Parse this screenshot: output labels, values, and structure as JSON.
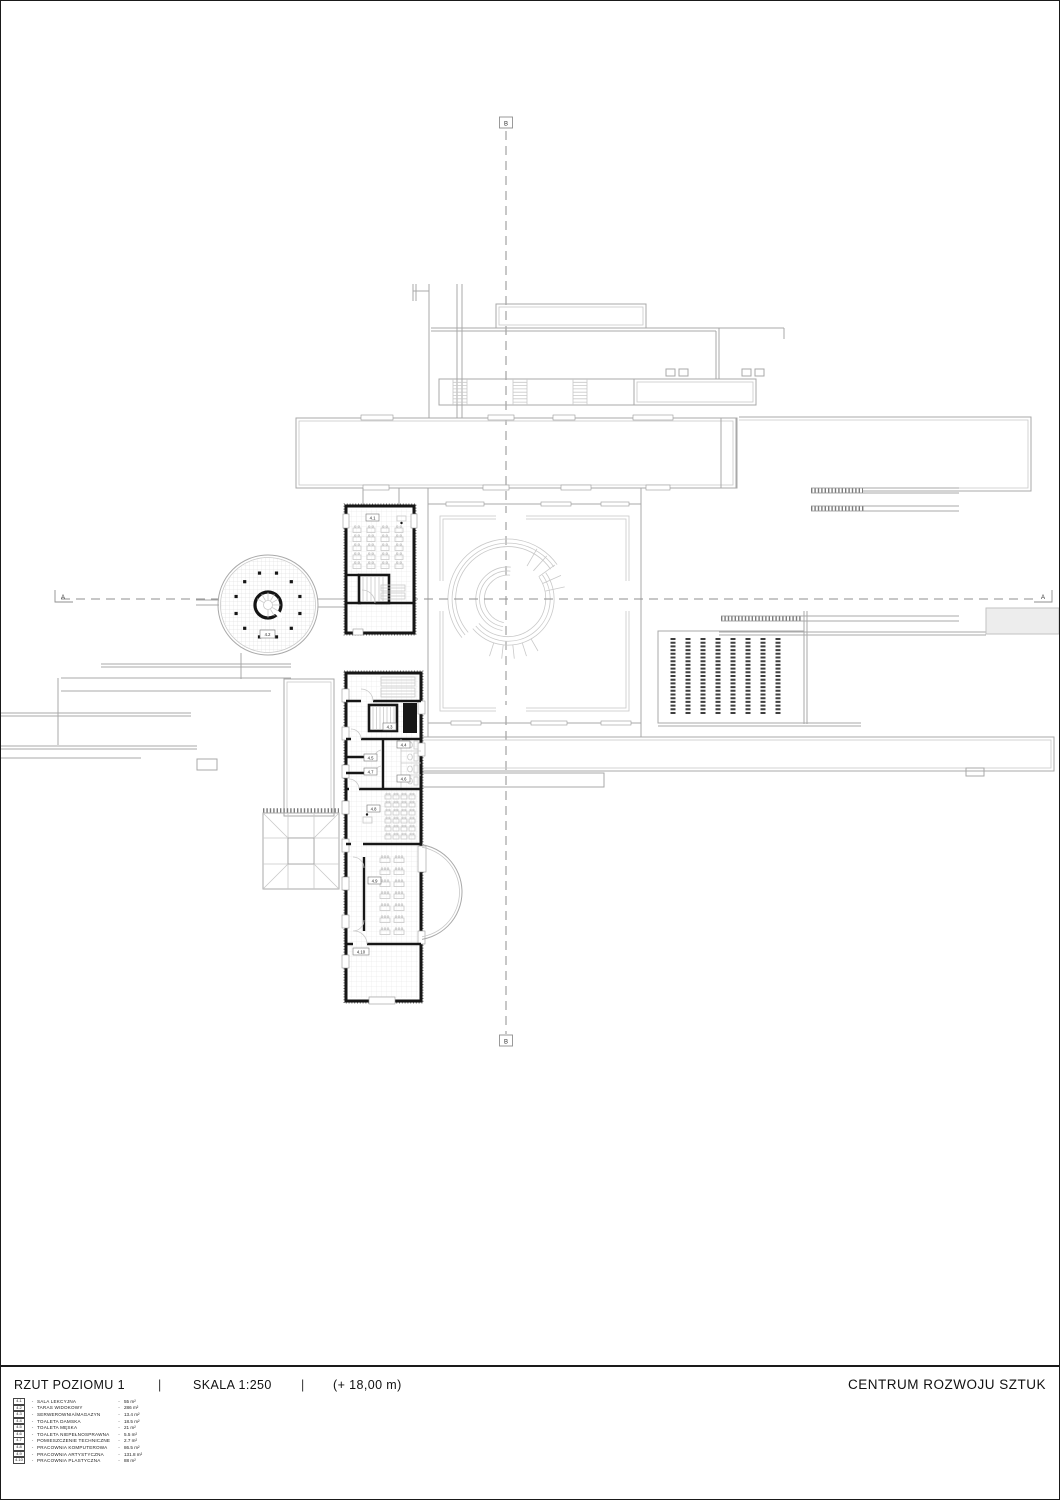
{
  "title_block": {
    "drawing_title": "RZUT POZIOMU 1",
    "separator": "|",
    "scale": "SKALA 1:250",
    "level": "(+ 18,00 m)",
    "project_title": "CENTRUM ROZWOJU SZTUK"
  },
  "legend": {
    "separator": "-",
    "items": [
      {
        "tag": "4.1",
        "name": "SALA LEKCYJNA",
        "area": "55 m²"
      },
      {
        "tag": "4.2",
        "name": "TARAS WIDOKOWY",
        "area": "286 m²"
      },
      {
        "tag": "4.3",
        "name": "SERWEROWNIA/MAGAZYN",
        "area": "13.4 m²"
      },
      {
        "tag": "4.4",
        "name": "TOALETA DAMSKA",
        "area": "18.5 m²"
      },
      {
        "tag": "4.5",
        "name": "TOALETA MĘSKA",
        "area": "21 m²"
      },
      {
        "tag": "4.6",
        "name": "TOALETA NIEPEŁNOSPRAWNA",
        "area": "5.5 m²"
      },
      {
        "tag": "4.7",
        "name": "POMIESZCZENIE TECHNICZNE",
        "area": "2.7 m²"
      },
      {
        "tag": "4.8",
        "name": "PRACOWNIA KOMPUTEROWA",
        "area": "86.5 m²"
      },
      {
        "tag": "4.9",
        "name": "PRACOWNIA ARTYSTYCZNA",
        "area": "131.8 m²"
      },
      {
        "tag": "4.10",
        "name": "PRACOWNIA PLASTYCZNA",
        "area": "88 m²"
      }
    ]
  },
  "credits": {
    "lines": [
      {
        "text": "DYPLOM MAGISTERSKI"
      },
      {
        "text": "AUTOR: DAMIEN BEAUMONT"
      },
      {
        "text": "PROMOTOR: PROF. DR HAB. ARCH. TOMASZ KOZŁOWSKI"
      },
      {
        "text": "ROK AKADEMICKI: 2023 / 2024"
      },
      {
        "text": "POLITECHNIKA KRAKOWSKA"
      },
      {
        "text": "WYDZIAŁ ARCHITEKTURY"
      },
      {
        "text": "KATEDRA PROJEKTOWANIA ARCHITEKTONICZNEGO"
      }
    ]
  },
  "plan": {
    "axis": {
      "a": "A",
      "b": "B"
    },
    "tags": {
      "r41": "4.1",
      "r42": "4.2",
      "r43": "4.3",
      "r44": "4.4",
      "r45": "4.5",
      "r46": "4.6",
      "r47": "4.7",
      "r48": "4.8",
      "r49": "4.9",
      "r410": "4.10"
    }
  },
  "colors": {
    "paper": "#ffffff",
    "frame": "#1a1a1a",
    "wall": "#161616",
    "line_light": "#a9a9a9",
    "axis": "#8f8f8f",
    "louver": "#3f3f3f"
  }
}
